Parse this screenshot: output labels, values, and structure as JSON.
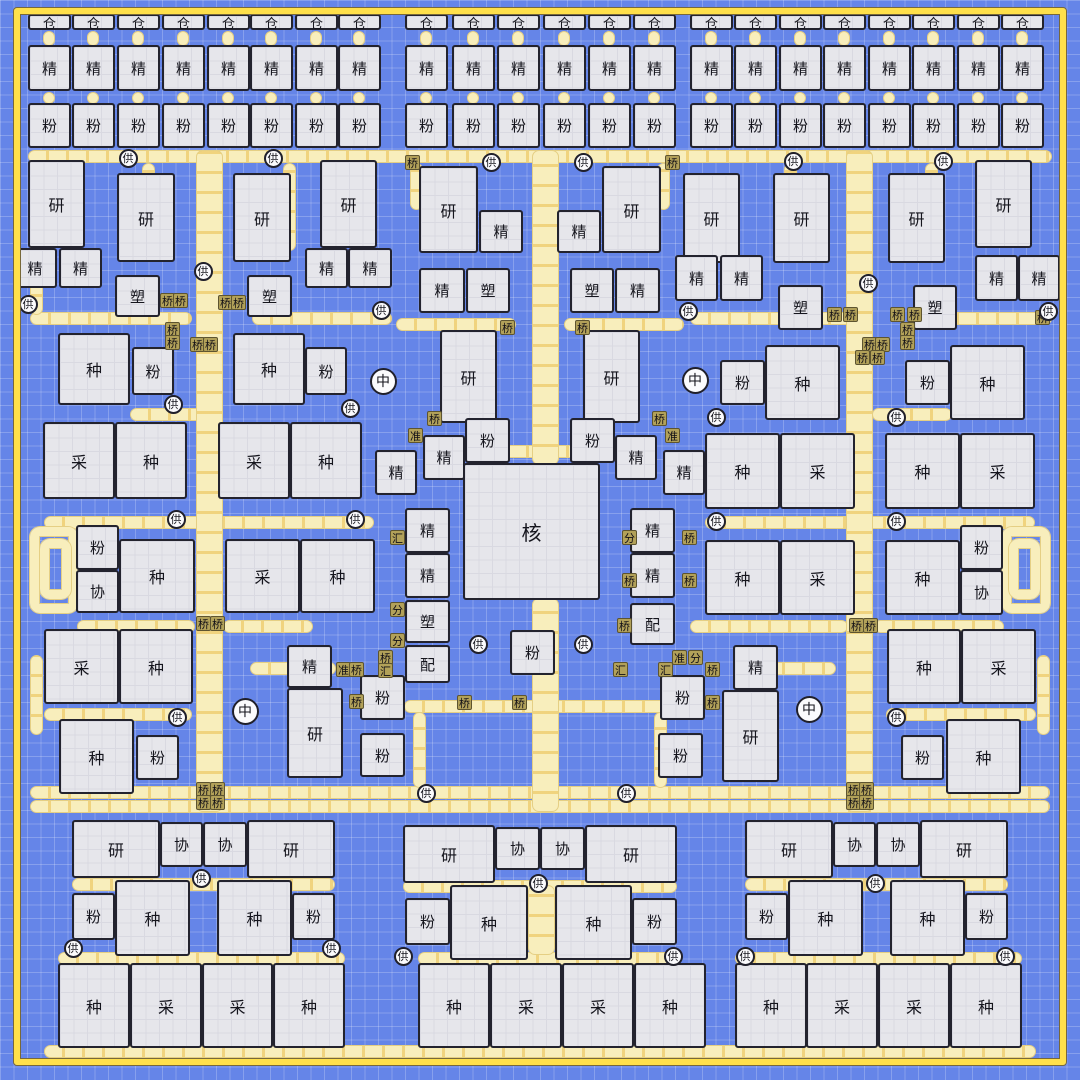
{
  "colors": {
    "background": "#6585e8",
    "grid_line": "#8aa2f0",
    "frame": "#ffe04a",
    "building_fill": "#e6e6eb",
    "building_border": "#23232e",
    "belt_fill": "#f8eebc",
    "belt_edge": "#e5cf84",
    "belt_arrow": "#ecc55c",
    "device_tile": "#b2a159",
    "node_fill": "#fbfbfd"
  },
  "frame": {
    "x": 14,
    "y": 8,
    "w": 1052,
    "h": 1057
  },
  "types": {
    "仓": "storage",
    "精": "refiner",
    "粉": "mill",
    "研": "lab",
    "塑": "molder",
    "种": "planter",
    "采": "harvester",
    "核": "core",
    "协": "assist",
    "配": "dispatcher",
    "供": "supply",
    "中": "hub",
    "桥": "bridge",
    "准": "aligner",
    "汇": "merger",
    "分": "splitter"
  },
  "stacks": {
    "w": 43,
    "rows": [
      {
        "label": "仓",
        "y": 14,
        "h": 16
      },
      {
        "label": "精",
        "y": 45,
        "h": 46
      },
      {
        "label": "粉",
        "y": 103,
        "h": 45
      }
    ],
    "columns": [
      28,
      72,
      117,
      162,
      207,
      250,
      295,
      338,
      405,
      452,
      497,
      543,
      588,
      633,
      690,
      734,
      779,
      823,
      868,
      912,
      957,
      1001
    ]
  },
  "buildings": [
    [
      28,
      160,
      57,
      88,
      "研"
    ],
    [
      117,
      173,
      58,
      89,
      "研"
    ],
    [
      233,
      173,
      58,
      89,
      "研"
    ],
    [
      320,
      160,
      57,
      88,
      "研"
    ],
    [
      13,
      248,
      44,
      40,
      "精"
    ],
    [
      59,
      248,
      43,
      40,
      "精"
    ],
    [
      115,
      275,
      45,
      42,
      "塑"
    ],
    [
      247,
      275,
      45,
      42,
      "塑"
    ],
    [
      305,
      248,
      43,
      40,
      "精"
    ],
    [
      348,
      248,
      44,
      40,
      "精"
    ],
    [
      419,
      166,
      59,
      87,
      "研"
    ],
    [
      479,
      210,
      44,
      43,
      "精"
    ],
    [
      557,
      210,
      44,
      43,
      "精"
    ],
    [
      602,
      166,
      59,
      87,
      "研"
    ],
    [
      419,
      268,
      46,
      45,
      "精"
    ],
    [
      466,
      268,
      44,
      45,
      "塑"
    ],
    [
      570,
      268,
      44,
      45,
      "塑"
    ],
    [
      615,
      268,
      45,
      45,
      "精"
    ],
    [
      683,
      173,
      57,
      90,
      "研"
    ],
    [
      773,
      173,
      57,
      90,
      "研"
    ],
    [
      888,
      173,
      57,
      90,
      "研"
    ],
    [
      975,
      160,
      57,
      88,
      "研"
    ],
    [
      675,
      255,
      43,
      46,
      "精"
    ],
    [
      720,
      255,
      43,
      46,
      "精"
    ],
    [
      778,
      285,
      45,
      45,
      "塑"
    ],
    [
      913,
      285,
      44,
      45,
      "塑"
    ],
    [
      975,
      255,
      43,
      46,
      "精"
    ],
    [
      1018,
      255,
      42,
      46,
      "精"
    ],
    [
      58,
      333,
      72,
      72,
      "种"
    ],
    [
      132,
      347,
      42,
      48,
      "粉"
    ],
    [
      233,
      333,
      72,
      72,
      "种"
    ],
    [
      305,
      347,
      42,
      48,
      "粉"
    ],
    [
      440,
      330,
      57,
      93,
      "研"
    ],
    [
      583,
      330,
      57,
      93,
      "研"
    ],
    [
      720,
      360,
      45,
      45,
      "粉"
    ],
    [
      765,
      345,
      75,
      75,
      "种"
    ],
    [
      905,
      360,
      45,
      45,
      "粉"
    ],
    [
      950,
      345,
      75,
      75,
      "种"
    ],
    [
      465,
      418,
      45,
      45,
      "粉"
    ],
    [
      570,
      418,
      45,
      45,
      "粉"
    ],
    [
      423,
      435,
      42,
      45,
      "精"
    ],
    [
      375,
      450,
      42,
      45,
      "精"
    ],
    [
      615,
      435,
      42,
      45,
      "精"
    ],
    [
      663,
      450,
      42,
      45,
      "精"
    ],
    [
      463,
      463,
      137,
      137,
      "核"
    ],
    [
      43,
      422,
      72,
      77,
      "采"
    ],
    [
      115,
      422,
      72,
      77,
      "种"
    ],
    [
      218,
      422,
      72,
      77,
      "采"
    ],
    [
      290,
      422,
      72,
      77,
      "种"
    ],
    [
      705,
      433,
      75,
      76,
      "种"
    ],
    [
      780,
      433,
      75,
      76,
      "采"
    ],
    [
      885,
      433,
      75,
      76,
      "种"
    ],
    [
      960,
      433,
      75,
      76,
      "采"
    ],
    [
      405,
      508,
      45,
      45,
      "精"
    ],
    [
      405,
      553,
      45,
      45,
      "精"
    ],
    [
      405,
      600,
      45,
      43,
      "塑"
    ],
    [
      405,
      645,
      45,
      38,
      "配"
    ],
    [
      630,
      508,
      45,
      45,
      "精"
    ],
    [
      630,
      553,
      45,
      45,
      "精"
    ],
    [
      630,
      603,
      45,
      42,
      "配"
    ],
    [
      510,
      630,
      45,
      45,
      "粉"
    ],
    [
      76,
      525,
      43,
      45,
      "粉"
    ],
    [
      76,
      570,
      43,
      43,
      "协"
    ],
    [
      119,
      539,
      76,
      74,
      "种"
    ],
    [
      225,
      539,
      75,
      74,
      "采"
    ],
    [
      300,
      539,
      75,
      74,
      "种"
    ],
    [
      705,
      540,
      75,
      75,
      "种"
    ],
    [
      780,
      540,
      75,
      75,
      "采"
    ],
    [
      885,
      540,
      75,
      75,
      "种"
    ],
    [
      960,
      525,
      43,
      45,
      "粉"
    ],
    [
      960,
      570,
      43,
      45,
      "协"
    ],
    [
      44,
      629,
      75,
      75,
      "采"
    ],
    [
      119,
      629,
      74,
      75,
      "种"
    ],
    [
      887,
      629,
      74,
      75,
      "种"
    ],
    [
      961,
      629,
      75,
      75,
      "采"
    ],
    [
      287,
      645,
      45,
      43,
      "精"
    ],
    [
      287,
      688,
      56,
      90,
      "研"
    ],
    [
      360,
      675,
      45,
      45,
      "粉"
    ],
    [
      360,
      733,
      45,
      44,
      "粉"
    ],
    [
      733,
      645,
      45,
      45,
      "精"
    ],
    [
      722,
      690,
      57,
      92,
      "研"
    ],
    [
      660,
      675,
      45,
      45,
      "粉"
    ],
    [
      658,
      733,
      45,
      45,
      "粉"
    ],
    [
      59,
      719,
      75,
      75,
      "种"
    ],
    [
      136,
      735,
      43,
      45,
      "粉"
    ],
    [
      901,
      735,
      43,
      45,
      "粉"
    ],
    [
      946,
      719,
      75,
      75,
      "种"
    ],
    [
      72,
      820,
      88,
      58,
      "研"
    ],
    [
      160,
      822,
      43,
      45,
      "协"
    ],
    [
      203,
      822,
      44,
      45,
      "协"
    ],
    [
      247,
      820,
      88,
      58,
      "研"
    ],
    [
      403,
      825,
      92,
      58,
      "研"
    ],
    [
      495,
      827,
      45,
      43,
      "协"
    ],
    [
      540,
      827,
      45,
      43,
      "协"
    ],
    [
      585,
      825,
      92,
      58,
      "研"
    ],
    [
      745,
      820,
      88,
      58,
      "研"
    ],
    [
      833,
      822,
      43,
      45,
      "协"
    ],
    [
      876,
      822,
      44,
      45,
      "协"
    ],
    [
      920,
      820,
      88,
      58,
      "研"
    ],
    [
      72,
      893,
      43,
      47,
      "粉"
    ],
    [
      115,
      880,
      75,
      76,
      "种"
    ],
    [
      217,
      880,
      75,
      76,
      "种"
    ],
    [
      292,
      893,
      43,
      47,
      "粉"
    ],
    [
      405,
      898,
      45,
      47,
      "粉"
    ],
    [
      450,
      885,
      78,
      75,
      "种"
    ],
    [
      555,
      885,
      77,
      75,
      "种"
    ],
    [
      632,
      898,
      45,
      47,
      "粉"
    ],
    [
      745,
      893,
      43,
      47,
      "粉"
    ],
    [
      788,
      880,
      75,
      76,
      "种"
    ],
    [
      890,
      880,
      75,
      76,
      "种"
    ],
    [
      965,
      893,
      43,
      47,
      "粉"
    ],
    [
      58,
      963,
      72,
      85,
      "种"
    ],
    [
      130,
      963,
      72,
      85,
      "采"
    ],
    [
      202,
      963,
      71,
      85,
      "采"
    ],
    [
      273,
      963,
      72,
      85,
      "种"
    ],
    [
      418,
      963,
      72,
      85,
      "种"
    ],
    [
      490,
      963,
      72,
      85,
      "采"
    ],
    [
      562,
      963,
      72,
      85,
      "采"
    ],
    [
      634,
      963,
      72,
      85,
      "种"
    ],
    [
      735,
      963,
      72,
      85,
      "种"
    ],
    [
      806,
      963,
      72,
      85,
      "采"
    ],
    [
      878,
      963,
      72,
      85,
      "采"
    ],
    [
      950,
      963,
      72,
      85,
      "种"
    ]
  ],
  "tiles": [
    [
      405,
      155,
      "桥"
    ],
    [
      665,
      155,
      "桥"
    ],
    [
      160,
      293,
      "桥"
    ],
    [
      173,
      293,
      "桥"
    ],
    [
      218,
      295,
      "桥"
    ],
    [
      231,
      295,
      "桥"
    ],
    [
      165,
      322,
      "桥"
    ],
    [
      165,
      335,
      "桥"
    ],
    [
      190,
      337,
      "桥"
    ],
    [
      203,
      337,
      "桥"
    ],
    [
      827,
      307,
      "桥"
    ],
    [
      843,
      307,
      "桥"
    ],
    [
      890,
      307,
      "桥"
    ],
    [
      907,
      307,
      "桥"
    ],
    [
      900,
      322,
      "桥"
    ],
    [
      900,
      335,
      "桥"
    ],
    [
      862,
      337,
      "桥"
    ],
    [
      875,
      337,
      "桥"
    ],
    [
      500,
      320,
      "桥"
    ],
    [
      575,
      320,
      "桥"
    ],
    [
      1035,
      310,
      "桥"
    ],
    [
      427,
      411,
      "桥"
    ],
    [
      652,
      411,
      "桥"
    ],
    [
      408,
      428,
      "准"
    ],
    [
      665,
      428,
      "准"
    ],
    [
      855,
      350,
      "桥"
    ],
    [
      870,
      350,
      "桥"
    ],
    [
      390,
      530,
      "汇"
    ],
    [
      622,
      530,
      "分"
    ],
    [
      682,
      530,
      "桥"
    ],
    [
      682,
      573,
      "桥"
    ],
    [
      390,
      602,
      "分"
    ],
    [
      390,
      633,
      "分"
    ],
    [
      622,
      573,
      "桥"
    ],
    [
      617,
      618,
      "桥"
    ],
    [
      378,
      650,
      "桥"
    ],
    [
      378,
      663,
      "汇"
    ],
    [
      336,
      662,
      "准"
    ],
    [
      349,
      662,
      "桥"
    ],
    [
      349,
      694,
      "桥"
    ],
    [
      672,
      650,
      "准"
    ],
    [
      688,
      650,
      "分"
    ],
    [
      613,
      662,
      "汇"
    ],
    [
      658,
      662,
      "汇"
    ],
    [
      705,
      662,
      "桥"
    ],
    [
      705,
      695,
      "桥"
    ],
    [
      457,
      695,
      "桥"
    ],
    [
      512,
      695,
      "桥"
    ],
    [
      196,
      616,
      "桥"
    ],
    [
      210,
      616,
      "桥"
    ],
    [
      849,
      618,
      "桥"
    ],
    [
      863,
      618,
      "桥"
    ],
    [
      196,
      782,
      "桥"
    ],
    [
      210,
      782,
      "桥"
    ],
    [
      196,
      795,
      "桥"
    ],
    [
      210,
      795,
      "桥"
    ],
    [
      846,
      782,
      "桥"
    ],
    [
      859,
      782,
      "桥"
    ],
    [
      846,
      795,
      "桥"
    ],
    [
      859,
      795,
      "桥"
    ]
  ],
  "circles": [
    [
      130,
      160,
      23,
      "供"
    ],
    [
      275,
      160,
      23,
      "供"
    ],
    [
      493,
      164,
      23,
      "供"
    ],
    [
      585,
      164,
      23,
      "供"
    ],
    [
      795,
      163,
      23,
      "供"
    ],
    [
      945,
      163,
      23,
      "供"
    ],
    [
      30,
      306,
      23,
      "供"
    ],
    [
      205,
      273,
      23,
      "供"
    ],
    [
      383,
      312,
      23,
      "供"
    ],
    [
      690,
      313,
      23,
      "供"
    ],
    [
      870,
      285,
      23,
      "供"
    ],
    [
      1050,
      313,
      23,
      "供"
    ],
    [
      175,
      406,
      23,
      "供"
    ],
    [
      352,
      410,
      23,
      "供"
    ],
    [
      718,
      419,
      23,
      "供"
    ],
    [
      898,
      419,
      23,
      "供"
    ],
    [
      178,
      521,
      23,
      "供"
    ],
    [
      357,
      521,
      23,
      "供"
    ],
    [
      718,
      523,
      23,
      "供"
    ],
    [
      898,
      523,
      23,
      "供"
    ],
    [
      480,
      646,
      23,
      "供"
    ],
    [
      585,
      646,
      23,
      "供"
    ],
    [
      179,
      719,
      23,
      "供"
    ],
    [
      898,
      719,
      23,
      "供"
    ],
    [
      428,
      795,
      23,
      "供"
    ],
    [
      628,
      795,
      23,
      "供"
    ],
    [
      203,
      880,
      23,
      "供"
    ],
    [
      540,
      885,
      23,
      "供"
    ],
    [
      877,
      885,
      23,
      "供"
    ],
    [
      75,
      950,
      23,
      "供"
    ],
    [
      333,
      950,
      23,
      "供"
    ],
    [
      405,
      958,
      23,
      "供"
    ],
    [
      675,
      958,
      23,
      "供"
    ],
    [
      747,
      958,
      23,
      "供"
    ],
    [
      1007,
      958,
      23,
      "供"
    ],
    [
      385,
      383,
      31,
      "中"
    ],
    [
      697,
      382,
      31,
      "中"
    ],
    [
      247,
      713,
      31,
      "中"
    ],
    [
      811,
      711,
      31,
      "中"
    ]
  ],
  "belts": {
    "h": [
      [
        28,
        150,
        1024,
        13
      ],
      [
        30,
        786,
        1020,
        13
      ],
      [
        30,
        800,
        1020,
        13
      ],
      [
        44,
        1045,
        992,
        13
      ],
      [
        30,
        312,
        162,
        13
      ],
      [
        252,
        312,
        140,
        13
      ],
      [
        690,
        312,
        162,
        13
      ],
      [
        918,
        312,
        134,
        13
      ],
      [
        396,
        318,
        120,
        13
      ],
      [
        564,
        318,
        120,
        13
      ],
      [
        130,
        408,
        80,
        13
      ],
      [
        872,
        408,
        80,
        13
      ],
      [
        44,
        516,
        330,
        13
      ],
      [
        705,
        516,
        330,
        13
      ],
      [
        77,
        620,
        118,
        13
      ],
      [
        223,
        620,
        90,
        13
      ],
      [
        690,
        620,
        158,
        13
      ],
      [
        874,
        620,
        130,
        13
      ],
      [
        44,
        708,
        148,
        13
      ],
      [
        886,
        708,
        150,
        13
      ],
      [
        250,
        662,
        86,
        13
      ],
      [
        744,
        662,
        92,
        13
      ],
      [
        404,
        700,
        272,
        13
      ],
      [
        448,
        445,
        184,
        13
      ],
      [
        72,
        878,
        263,
        13
      ],
      [
        403,
        880,
        274,
        13
      ],
      [
        745,
        878,
        263,
        13
      ],
      [
        58,
        952,
        287,
        13
      ],
      [
        418,
        952,
        260,
        13
      ],
      [
        735,
        952,
        287,
        13
      ]
    ],
    "v": [
      [
        196,
        150,
        662,
        27
      ],
      [
        846,
        150,
        662,
        27
      ],
      [
        532,
        150,
        315,
        27
      ],
      [
        532,
        598,
        214,
        27
      ],
      [
        30,
        165,
        150,
        13
      ],
      [
        142,
        163,
        88,
        13
      ],
      [
        283,
        163,
        88,
        13
      ],
      [
        925,
        163,
        88,
        13
      ],
      [
        784,
        163,
        88,
        13
      ],
      [
        410,
        163,
        47,
        13
      ],
      [
        657,
        163,
        47,
        13
      ],
      [
        478,
        338,
        82,
        13
      ],
      [
        590,
        338,
        82,
        13
      ],
      [
        30,
        655,
        80,
        13
      ],
      [
        1037,
        655,
        80,
        13
      ],
      [
        413,
        712,
        76,
        13
      ],
      [
        654,
        712,
        76,
        13
      ],
      [
        528,
        885,
        70,
        27
      ]
    ],
    "coils": [
      [
        30,
        527,
        48,
        86
      ],
      [
        40,
        539,
        31,
        60
      ],
      [
        1002,
        527,
        48,
        86
      ],
      [
        1009,
        539,
        31,
        60
      ]
    ]
  }
}
